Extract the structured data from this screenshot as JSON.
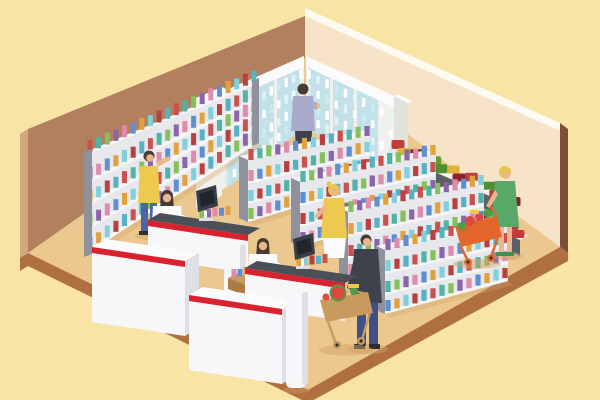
{
  "image": {
    "type": "isometric flat vector illustration",
    "subject": "Supermarket grocery store interior with shelves, refrigerated cases, produce stand, checkout counters, cashiers and shoppers with carts",
    "width": 600,
    "height": 400,
    "visible_text": "none"
  },
  "colors": {
    "bg": "#f8e4a5",
    "wallLeft": "#b2805f",
    "wallLeftSide": "#d0a97c",
    "wallTrim": "#fdfaf2",
    "wallRight": "#f7e3c8",
    "wallRightSide": "#7e4f38",
    "floor": "#ebc88f",
    "floorEdge": "#b06f41",
    "shadow": "#d2a267",
    "shelfGray": "#8f919b",
    "shelfBack": "#e7e8ec",
    "shelfWhite": "#f6f6f8",
    "fridgeFrame": "#f0f0ec",
    "fridgeSide": "#e3e3de",
    "fridgeGlass": "#c3e1e9",
    "counterWhite": "#f7f7f9",
    "counterShade": "#dfdfe6",
    "counterTop": "#4b4f58",
    "accentRed": "#d8232f",
    "monitor": "#3a3d45",
    "monitorDark": "#22252c",
    "produceStand": "#5d5f66",
    "skin": "#eab68c",
    "hairDark": "#473b33",
    "hairBlonde": "#e8c54d",
    "white": "#fbfbfc",
    "outfitYellow": "#edc94e",
    "jeans": "#4a66a8",
    "suit": "#3d424d",
    "navy": "#3f5088",
    "lavender": "#a9aac9",
    "dressGreen": "#5aa868",
    "shoeGreen": "#3e8f50",
    "shoeDark": "#2f2d2f",
    "cartOrange": "#e2662c",
    "cartTan": "#c89a5e",
    "cartTanDark": "#a87c44",
    "watermelonRed": "#d84a3f",
    "leafGreen": "#4f9c49"
  },
  "palettes": {
    "box": [
      "#c9524f",
      "#4fb3a5",
      "#86c05d",
      "#8a65a8",
      "#e08bac",
      "#5f8fd3",
      "#e2a13f",
      "#7fd0da",
      "#b8413f",
      "#55b1c4"
    ],
    "bottle": [
      "#ffffff",
      "#e2f2f5",
      "#ffffff",
      "#cdeaf0"
    ],
    "crate": [
      "#c23b3b",
      "#7a2430",
      "#639d2f",
      "#e0b23c",
      "#b8413f",
      "#4f8f2f",
      "#8a2430",
      "#d0812f"
    ]
  },
  "illustration": {
    "room": {
      "left_wall": "brown",
      "right_wall": "pale peach with white top trim",
      "floor": "tan with dark brown front edge band",
      "background": "pale yellow"
    },
    "people": [
      {
        "role": "clerk restocking shelves",
        "location": "left wall shelf",
        "hair": "dark",
        "outfit": "yellow apron, blue trousers"
      },
      {
        "role": "customer browsing drinks fridge",
        "location": "back corner",
        "hair": "dark",
        "outfit": "lavender shirt, grey trousers"
      },
      {
        "role": "cashier",
        "location": "checkout 1",
        "hair": "dark",
        "outfit": "white shirt"
      },
      {
        "role": "cashier",
        "location": "checkout 2",
        "hair": "dark",
        "outfit": "white shirt"
      },
      {
        "role": "customer waiting at checkout",
        "location": "checkout 2",
        "hair": "blonde",
        "outfit": "yellow top, white skirt"
      },
      {
        "role": "customer pushing cart with watermelon",
        "location": "center aisle",
        "hair": "dark",
        "outfit": "dark suit, navy trousers"
      },
      {
        "role": "customer pushing cart",
        "location": "produce stand",
        "hair": "blonde",
        "outfit": "green dress, green shoes"
      }
    ],
    "fixtures": [
      {
        "name": "refrigerated wall cases",
        "count": 2,
        "contents": "bottled drinks"
      },
      {
        "name": "wall shelf unit",
        "count": 1,
        "contents": "boxed goods"
      },
      {
        "name": "aisle gondola shelves",
        "count": 4,
        "contents": "boxed goods"
      },
      {
        "name": "produce display tiers",
        "count": 2,
        "contents": "fruit and vegetable crates"
      },
      {
        "name": "checkout counters with POS monitors",
        "count": 2
      },
      {
        "name": "checkout gate pillars",
        "count": 2
      },
      {
        "name": "impulse basket table",
        "count": 1
      },
      {
        "name": "shopping carts",
        "count": 2,
        "contents": "watermelon and produce"
      }
    ],
    "product_rows": [
      {
        "layer": "pl-leftshelf",
        "kind": "box",
        "x1": 90,
        "y1": 152,
        "x2": 254,
        "y2": 82,
        "n": 20,
        "w": 5,
        "h": 12,
        "o": 0
      },
      {
        "layer": "pl-leftshelf",
        "kind": "box",
        "x1": 90,
        "y1": 179,
        "x2": 254,
        "y2": 98,
        "n": 20,
        "w": 5,
        "h": 12,
        "o": 3
      },
      {
        "layer": "pl-leftshelf",
        "kind": "box",
        "x1": 90,
        "y1": 202,
        "x2": 254,
        "y2": 112,
        "n": 20,
        "w": 5,
        "h": 12,
        "o": 6
      },
      {
        "layer": "pl-leftshelf",
        "kind": "box",
        "x1": 90,
        "y1": 226,
        "x2": 254,
        "y2": 126,
        "n": 20,
        "w": 5,
        "h": 12,
        "o": 2
      },
      {
        "layer": "pl-leftshelf",
        "kind": "box",
        "x1": 90,
        "y1": 249,
        "x2": 254,
        "y2": 140,
        "n": 20,
        "w": 5,
        "h": 12,
        "o": 5
      },
      {
        "layer": "pl-fridgeA",
        "kind": "bottle",
        "x1": 227,
        "y1": 120,
        "x2": 301,
        "y2": 79,
        "n": 11,
        "w": 3.4,
        "h": 9,
        "o": 0
      },
      {
        "layer": "pl-fridgeA",
        "kind": "bottle",
        "x1": 227,
        "y1": 142,
        "x2": 301,
        "y2": 94,
        "n": 11,
        "w": 3.4,
        "h": 9,
        "o": 1
      },
      {
        "layer": "pl-fridgeA",
        "kind": "bottle",
        "x1": 227,
        "y1": 164,
        "x2": 301,
        "y2": 110,
        "n": 11,
        "w": 3.4,
        "h": 9,
        "o": 2
      },
      {
        "layer": "pl-fridgeA",
        "kind": "bottle",
        "x1": 227,
        "y1": 183,
        "x2": 301,
        "y2": 123,
        "n": 11,
        "w": 3.4,
        "h": 9,
        "o": 3
      },
      {
        "layer": "pl-fridgeB",
        "kind": "bottle",
        "x1": 309,
        "y1": 79,
        "x2": 391,
        "y2": 121,
        "n": 10,
        "w": 3.4,
        "h": 9,
        "o": 0
      },
      {
        "layer": "pl-fridgeB",
        "kind": "bottle",
        "x1": 309,
        "y1": 94,
        "x2": 391,
        "y2": 138,
        "n": 10,
        "w": 3.4,
        "h": 9,
        "o": 1
      },
      {
        "layer": "pl-fridgeB",
        "kind": "bottle",
        "x1": 309,
        "y1": 110,
        "x2": 391,
        "y2": 155,
        "n": 10,
        "w": 3.4,
        "h": 9,
        "o": 2
      },
      {
        "layer": "pl-fridgeB",
        "kind": "bottle",
        "x1": 309,
        "y1": 123,
        "x2": 391,
        "y2": 170,
        "n": 10,
        "w": 3.4,
        "h": 9,
        "o": 3
      },
      {
        "layer": "pl-g1",
        "kind": "box",
        "x1": 251,
        "y1": 160,
        "x2": 367,
        "y2": 136,
        "n": 14,
        "w": 5.2,
        "h": 11,
        "o": 0
      },
      {
        "layer": "pl-g1",
        "kind": "box",
        "x1": 251,
        "y1": 181,
        "x2": 367,
        "y2": 152,
        "n": 14,
        "w": 5.2,
        "h": 11,
        "o": 4
      },
      {
        "layer": "pl-g1",
        "kind": "box",
        "x1": 251,
        "y1": 201,
        "x2": 367,
        "y2": 169,
        "n": 14,
        "w": 5.2,
        "h": 11,
        "o": 7
      },
      {
        "layer": "pl-g1",
        "kind": "box",
        "x1": 251,
        "y1": 219,
        "x2": 367,
        "y2": 182,
        "n": 14,
        "w": 5.2,
        "h": 11,
        "o": 2
      },
      {
        "layer": "pl-g2",
        "kind": "box",
        "x1": 303,
        "y1": 182,
        "x2": 433,
        "y2": 155,
        "n": 16,
        "w": 5.2,
        "h": 11,
        "o": 1
      },
      {
        "layer": "pl-g2",
        "kind": "box",
        "x1": 303,
        "y1": 203,
        "x2": 433,
        "y2": 172,
        "n": 16,
        "w": 5.2,
        "h": 11,
        "o": 5
      },
      {
        "layer": "pl-g2",
        "kind": "box",
        "x1": 303,
        "y1": 224,
        "x2": 433,
        "y2": 190,
        "n": 16,
        "w": 5.2,
        "h": 11,
        "o": 8
      },
      {
        "layer": "pl-g2",
        "kind": "box",
        "x1": 303,
        "y1": 243,
        "x2": 433,
        "y2": 205,
        "n": 16,
        "w": 5.2,
        "h": 11,
        "o": 3
      },
      {
        "layer": "pl-g3",
        "kind": "box",
        "x1": 351,
        "y1": 212,
        "x2": 481,
        "y2": 185,
        "n": 16,
        "w": 5.2,
        "h": 11,
        "o": 2
      },
      {
        "layer": "pl-g3",
        "kind": "box",
        "x1": 351,
        "y1": 234,
        "x2": 481,
        "y2": 203,
        "n": 16,
        "w": 5.2,
        "h": 11,
        "o": 6
      },
      {
        "layer": "pl-g3",
        "kind": "box",
        "x1": 351,
        "y1": 256,
        "x2": 481,
        "y2": 221,
        "n": 16,
        "w": 5.2,
        "h": 11,
        "o": 0
      },
      {
        "layer": "pl-g3",
        "kind": "box",
        "x1": 351,
        "y1": 275,
        "x2": 481,
        "y2": 237,
        "n": 16,
        "w": 5.2,
        "h": 11,
        "o": 4
      },
      {
        "layer": "pl-g4",
        "kind": "box",
        "x1": 388,
        "y1": 250,
        "x2": 505,
        "y2": 224,
        "n": 14,
        "w": 5.2,
        "h": 11,
        "o": 3
      },
      {
        "layer": "pl-g4",
        "kind": "box",
        "x1": 388,
        "y1": 271,
        "x2": 505,
        "y2": 243,
        "n": 14,
        "w": 5.2,
        "h": 11,
        "o": 7
      },
      {
        "layer": "pl-g4",
        "kind": "box",
        "x1": 388,
        "y1": 292,
        "x2": 505,
        "y2": 261,
        "n": 14,
        "w": 5.2,
        "h": 11,
        "o": 1
      },
      {
        "layer": "pl-g4",
        "kind": "box",
        "x1": 388,
        "y1": 311,
        "x2": 505,
        "y2": 278,
        "n": 14,
        "w": 5.2,
        "h": 11,
        "o": 5
      },
      {
        "layer": "pl-produceA",
        "kind": "crate",
        "x1": 398,
        "y1": 149,
        "x2": 508,
        "y2": 198,
        "n": 7,
        "w": 13,
        "h": 9,
        "o": 0
      },
      {
        "layer": "pl-produceA",
        "kind": "crate",
        "x1": 404,
        "y1": 157,
        "x2": 514,
        "y2": 206,
        "n": 7,
        "w": 13,
        "h": 9,
        "o": 3
      },
      {
        "layer": "pl-produceB",
        "kind": "crate",
        "x1": 380,
        "y1": 172,
        "x2": 512,
        "y2": 230,
        "n": 8,
        "w": 13,
        "h": 9,
        "o": 5
      },
      {
        "layer": "pl-produceB",
        "kind": "crate",
        "x1": 386,
        "y1": 180,
        "x2": 518,
        "y2": 238,
        "n": 8,
        "w": 13,
        "h": 9,
        "o": 1
      },
      {
        "layer": "pl-counterA",
        "kind": "box",
        "x1": 202,
        "y1": 218,
        "x2": 228,
        "y2": 215,
        "n": 5,
        "w": 5,
        "h": 9,
        "o": 2
      },
      {
        "layer": "pl-counterB",
        "kind": "box",
        "x1": 299,
        "y1": 266,
        "x2": 325,
        "y2": 263,
        "n": 5,
        "w": 5,
        "h": 9,
        "o": 6
      },
      {
        "layer": "pl-basket",
        "kind": "box",
        "x1": 234,
        "y1": 277,
        "x2": 258,
        "y2": 273,
        "n": 5,
        "w": 5,
        "h": 8,
        "o": 4
      }
    ]
  }
}
